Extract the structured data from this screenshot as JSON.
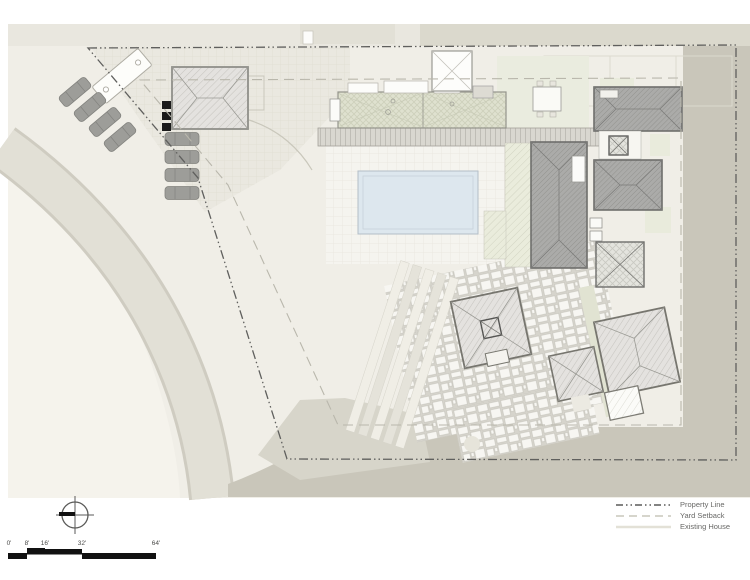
{
  "legend": {
    "items": [
      {
        "label": "Property Line",
        "line_style": "dash-dot",
        "color": "#5a5a58"
      },
      {
        "label": "Yard Setback",
        "line_style": "dashed",
        "color": "#c9c7bc"
      },
      {
        "label": "Existing House",
        "line_style": "solid",
        "color": "#e3e1d7"
      }
    ]
  },
  "scale_bar": {
    "labels": [
      "0'",
      "8'",
      "16'",
      "32'",
      "64'"
    ]
  },
  "north_arrow": {
    "icon": "north-arrow-icon"
  },
  "palette": {
    "sheet": "#f0eee7",
    "outside_property": "#c9c6ba",
    "road": "#e2e0d6",
    "pool_water": "#dde7ee",
    "roof_dark": "#ababa9",
    "roof_light": "#e4e2df",
    "trellis_green": "#dfe1cf",
    "car_gray": "#9d9d99",
    "property_line": "#5f5f5d",
    "setback_line": "#b9b7ac"
  }
}
